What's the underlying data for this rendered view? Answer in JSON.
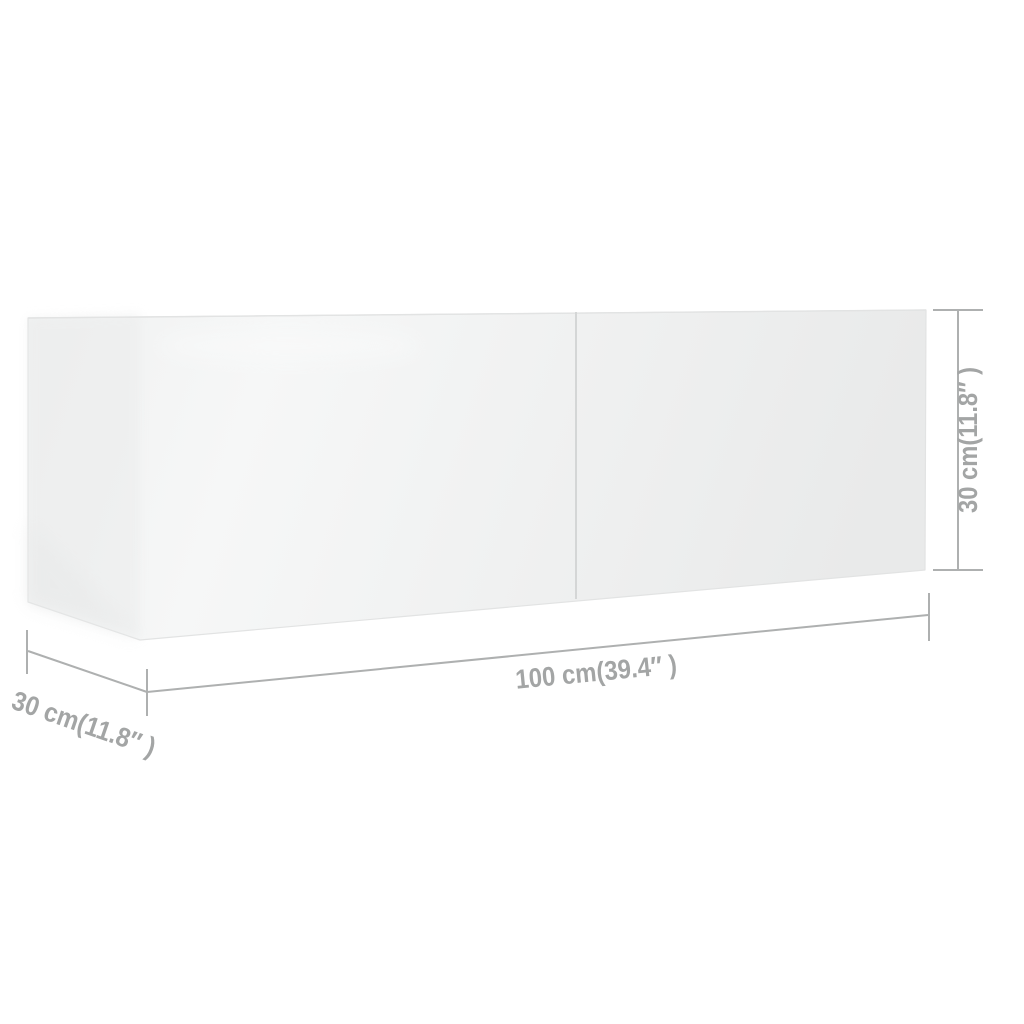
{
  "scene": {
    "background_color": "#ffffff",
    "product": {
      "kind": "tv-cabinet-3d-render",
      "front_color_left": "#f0f1f1",
      "front_color_mid": "#f6f7f7",
      "front_color_right": "#e9eaea",
      "side_color": "#ebecec",
      "divider_color": "#d4d6d6",
      "edge_color": "#e2e3e3"
    },
    "dimensions": {
      "line_color": "#aeb0b0",
      "text_color": "#a3a5a5",
      "width": {
        "label": "100 cm(39.4″ )"
      },
      "depth": {
        "label": "30 cm(11.8″ )"
      },
      "height": {
        "label": "30 cm(11.8″ )"
      }
    }
  }
}
